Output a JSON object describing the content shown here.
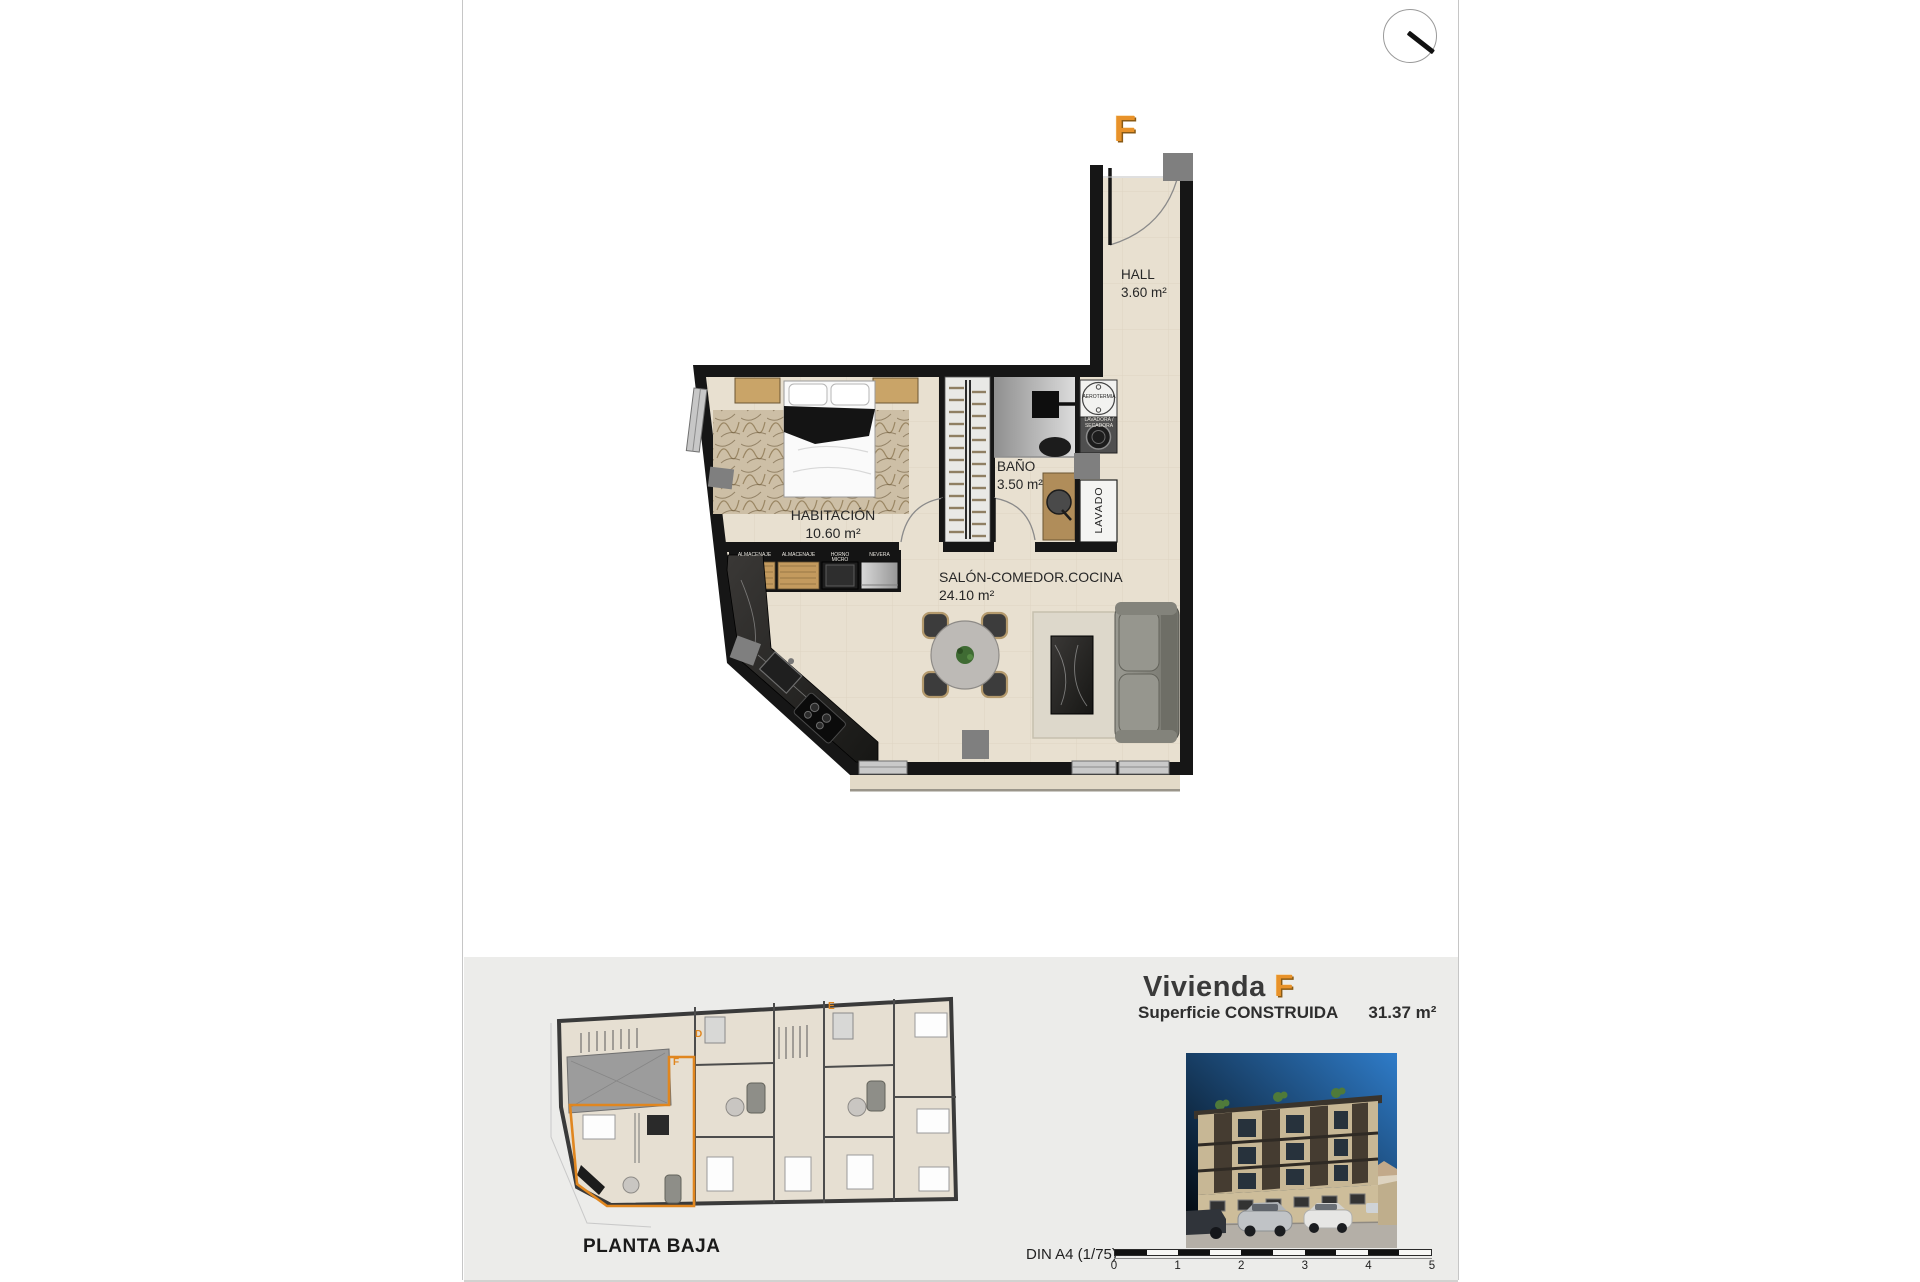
{
  "plan": {
    "unit_letter": "F",
    "hall": {
      "name": "HALL",
      "area": "3.60 m²"
    },
    "bano": {
      "name": "BAÑO",
      "area": "3.50 m²"
    },
    "habitacion": {
      "name": "HABITACIÓN",
      "area": "10.60 m²"
    },
    "salon": {
      "name": "SALÓN-COMEDOR.COCINA",
      "area": "24.10 m²"
    },
    "lavado": "LAVADO",
    "aerotermia": "AEROTERMIA",
    "lavadora_secadora": "LAVADORA / SECADORA",
    "cabinets": [
      "ALMACENAJE",
      "ALMACENAJE",
      "HORNO MICRO",
      "NEVERA"
    ]
  },
  "footer": {
    "site_plan": {
      "title": "PLANTA BAJA",
      "letters": {
        "d": "D",
        "e": "E",
        "f": "F"
      }
    },
    "dwelling": {
      "title": "Vivienda",
      "unit_letter": "F",
      "surface_label": "Superficie CONSTRUIDA",
      "surface_value": "31.37 m²"
    },
    "scale": {
      "label": "DIN A4 (1/75)",
      "ticks": [
        "0",
        "1",
        "2",
        "3",
        "4",
        "5"
      ]
    }
  },
  "colors": {
    "accent_orange": "#e8922a",
    "wall_black": "#161616",
    "floor_beige": "#e8e0d0",
    "footer_gray": "#ececea"
  }
}
